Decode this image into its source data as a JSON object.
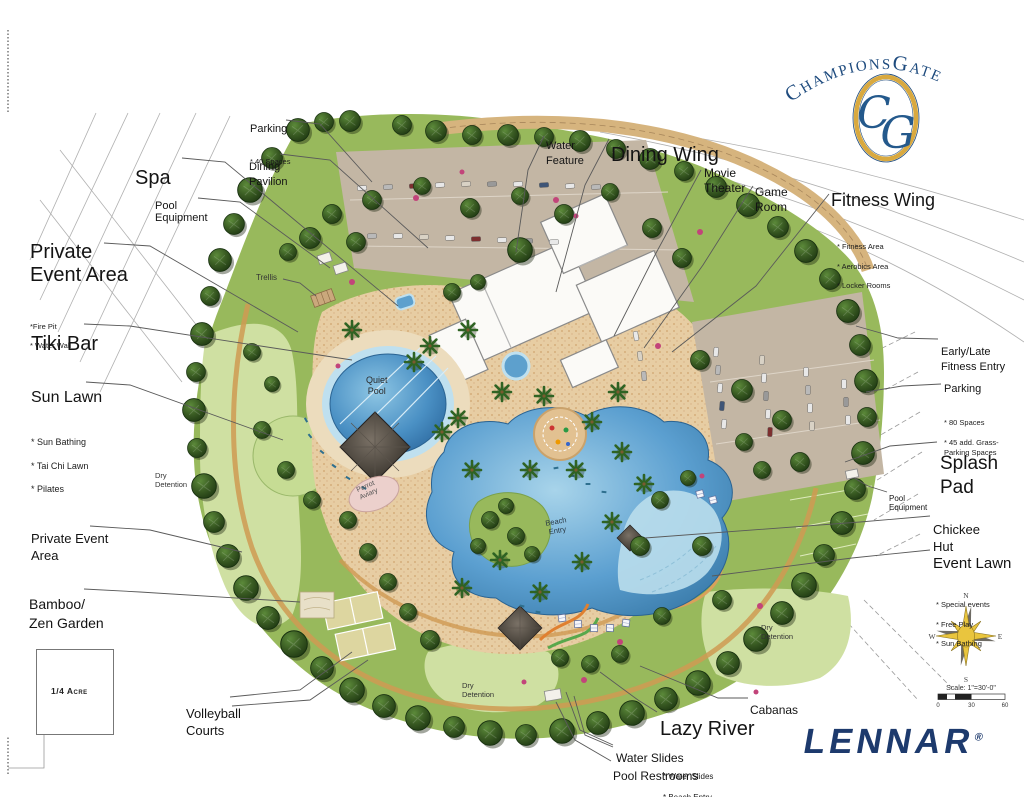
{
  "branding": {
    "arc": {
      "c1": "C",
      "t1": "HAMPIONS",
      "c2": "G",
      "t2": "ATE"
    },
    "monogram": {
      "c": "C",
      "g": "G"
    },
    "lennar": "LENNAR",
    "registered": "®"
  },
  "compass": {
    "north": "N",
    "south": "S",
    "east": "E",
    "west": "W"
  },
  "scalebar": {
    "label": "Scale: 1\"=30'-0\"",
    "tick_0": "0",
    "tick_30": "30",
    "tick_60": "60"
  },
  "area_reference": "1/4 Acre",
  "callouts": {
    "spa": {
      "label": "Spa"
    },
    "pool_equipment_left": {
      "label": "Pool\nEquipment"
    },
    "private_event_area_north": {
      "label": "Private\nEvent Area",
      "subs": [
        "*Fire Pit",
        "* Water Wall"
      ]
    },
    "tiki_bar": {
      "label": "Tiki Bar"
    },
    "sun_lawn": {
      "label": "Sun Lawn",
      "subs": [
        "* Sun Bathing",
        "* Tai Chi Lawn",
        "* Pilates"
      ]
    },
    "private_event_area_south": {
      "label": "Private Event\nArea"
    },
    "bamboo_zen_garden": {
      "label": "Bamboo/\nZen Garden"
    },
    "volleyball_courts": {
      "label": "Volleyball\nCourts"
    },
    "parking_north": {
      "label": "Parking",
      "subs": [
        "* 40 Spaces"
      ]
    },
    "dining_pavilion": {
      "label": "Dining\nPavilion"
    },
    "water_feature": {
      "label": "Water\nFeature"
    },
    "dining_wing": {
      "label": "Dining Wing"
    },
    "movie_theater": {
      "label": "Movie\nTheater"
    },
    "game_room": {
      "label": "Game\nRoom"
    },
    "fitness_wing": {
      "label": "Fitness Wing",
      "subs": [
        "* Fitness Area",
        "* Aerobics Area",
        "* Locker Rooms"
      ]
    },
    "early_late_fitness_entry": {
      "label": "Early/Late\nFitness Entry"
    },
    "parking_east": {
      "label": "Parking",
      "subs": [
        "* 80 Spaces",
        "* 45 add. Grass-\n   Parking Spaces"
      ]
    },
    "splash_pad": {
      "label": "Splash\nPad"
    },
    "pool_equipment_right": {
      "label": "Pool\nEquipment"
    },
    "chickee_hut": {
      "label": "Chickee\nHut"
    },
    "event_lawn": {
      "label": "Event Lawn",
      "subs": [
        "* Special events",
        "* Free Play",
        "* Sun Bathing"
      ]
    },
    "cabanas": {
      "label": "Cabanas"
    },
    "lazy_river": {
      "label": "Lazy River",
      "subs": [
        "* Water Slides",
        "* Beach Entry"
      ]
    },
    "water_slides": {
      "label": "Water Slides"
    },
    "pool_restrooms": {
      "label": "Pool Restrooms"
    }
  },
  "map_labels": {
    "trellis": "Trellis",
    "quiet_pool": "Quiet\nPool",
    "parrot_aviary": "Parrot\nAviary",
    "beach_entry": "Beach\nEntry",
    "dry_detention_west": "Dry\nDetention",
    "dry_detention_south": "Dry\nDetention",
    "dry_detention_east": "Dry\nDetention"
  },
  "colors": {
    "logo_navy": "#1e4b7e",
    "logo_gold": "#d9a93f",
    "lennar_navy": "#1d3a6d",
    "water_blue": "#4a90c4",
    "canopy_green": "#33511f",
    "lawn_green": "#cfe0a2",
    "plaza_tan": "#e7cda3",
    "parking_gray": "#c3b6a4"
  }
}
